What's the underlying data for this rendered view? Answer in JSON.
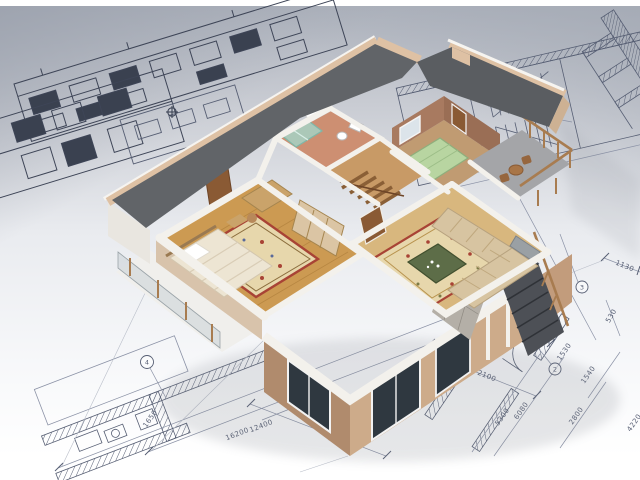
{
  "alt": "3D cutaway model of a two-storey house with furnished rooms standing on architectural blueprint drawings with dimension lines",
  "dimension_labels": [
    {
      "id": "len-16200",
      "text": "16200"
    },
    {
      "id": "len-12400",
      "text": "12400"
    },
    {
      "id": "len-1650",
      "text": "1650"
    },
    {
      "id": "len-2300",
      "text": "2300"
    },
    {
      "id": "len-6600",
      "text": "6600"
    },
    {
      "id": "len-2100",
      "text": "2100"
    },
    {
      "id": "len-5300",
      "text": "5300"
    },
    {
      "id": "len-6080",
      "text": "6080"
    },
    {
      "id": "len-2800",
      "text": "2800"
    },
    {
      "id": "len-1540",
      "text": "1540"
    },
    {
      "id": "len-4220",
      "text": "4220"
    },
    {
      "id": "len-1530",
      "text": "1530"
    },
    {
      "id": "len-530",
      "text": "530"
    },
    {
      "id": "len-520",
      "text": "520"
    },
    {
      "id": "len-1130",
      "text": "1130"
    },
    {
      "id": "len-3540",
      "text": "3540"
    }
  ],
  "grid_bubbles": [
    "4",
    "2",
    "3"
  ],
  "colors": {
    "paper_top": "#aeb3bd",
    "paper_mid": "#d3d6dc",
    "paper_light": "#f7f8fa",
    "ink_dark": "#3e4557",
    "ink_mid": "#565e73",
    "ink_light": "#8b92a6",
    "roof": "#616468",
    "roof_edge": "#dec1a4",
    "wall_light": "#e3cbb0",
    "wall_mid": "#c3a083",
    "wall_dark": "#a98263",
    "cut_wall": "#f3f1ec",
    "parquet": "#cc9a52",
    "rug_cream": "#e7d7ac",
    "rug_red": "#a84335",
    "rug_green": "#5d6d48",
    "bed_linen": "#ede5d3",
    "door_wood": "#8a5a34",
    "bath_floor": "#cd8f72",
    "shower_glass": "#a5d2c4",
    "green_bed": "#b8d5a1",
    "interior_brown": "#a87a60",
    "sofa": "#d7c4a1",
    "balcony_floor": "#a4a5a8",
    "rail_wood": "#a87c50",
    "stair_dark": "#4d5056",
    "glass_dark": "#2f3840",
    "stone": "#b4afa7"
  }
}
